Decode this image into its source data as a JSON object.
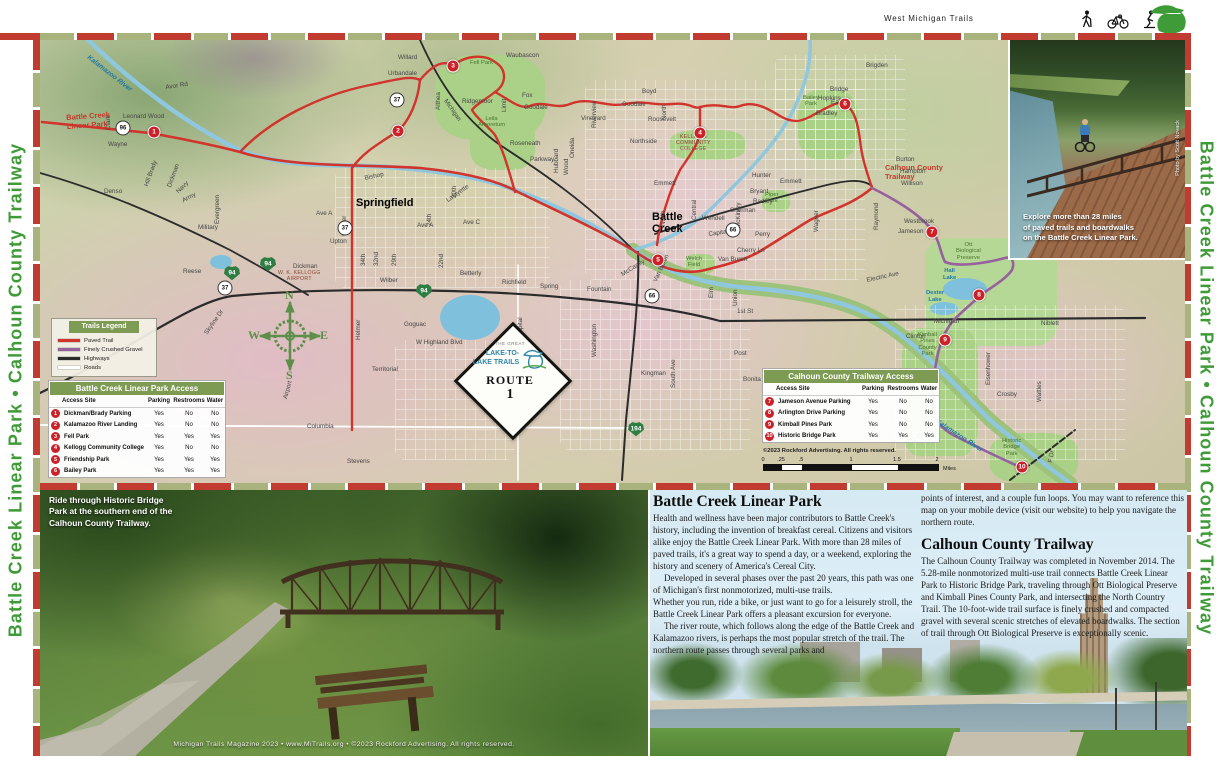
{
  "colors": {
    "accent_red": "#c23b31",
    "dash_green": "#a9b37e",
    "table_green": "#7d9b52",
    "sidebar_green": "#3f9b37",
    "trail_red": "#d0342c",
    "trail_purple": "#96619e",
    "water_blue": "#8ec7de",
    "marker_red": "#cc2128",
    "interstate_green": "#2e7d43"
  },
  "header": {
    "title": "West Michigan Trails"
  },
  "sidebars": {
    "left_text": "Battle Creek Linear Park • Calhoun County Trailway",
    "right_text": "Battle Creek Linear Park • Calhoun County Trailway"
  },
  "map": {
    "legend": {
      "title": "Trails Legend",
      "items": [
        {
          "label": "Paved Trail",
          "color": "#d0342c"
        },
        {
          "label": "Finely Crushed Gravel",
          "color": "#96619e"
        },
        {
          "label": "Highways",
          "color": "#2b2b2b"
        },
        {
          "label": "Roads",
          "color": "#ffffff"
        }
      ]
    },
    "access_tables": [
      {
        "id": "bc",
        "title": "Battle Creek Linear Park Access",
        "columns": [
          "Access Site",
          "Parking",
          "Restrooms",
          "Water"
        ],
        "rows": [
          {
            "num": "1",
            "site": "Dickman/Brady Parking",
            "values": [
              "Yes",
              "No",
              "No"
            ]
          },
          {
            "num": "2",
            "site": "Kalamazoo River Landing",
            "values": [
              "Yes",
              "No",
              "No"
            ]
          },
          {
            "num": "3",
            "site": "Fell Park",
            "values": [
              "Yes",
              "Yes",
              "Yes"
            ]
          },
          {
            "num": "4",
            "site": "Kellogg Community College",
            "values": [
              "Yes",
              "No",
              "No"
            ]
          },
          {
            "num": "5",
            "site": "Friendship Park",
            "values": [
              "Yes",
              "Yes",
              "Yes"
            ]
          },
          {
            "num": "6",
            "site": "Bailey Park",
            "values": [
              "Yes",
              "Yes",
              "Yes"
            ]
          }
        ]
      },
      {
        "id": "cc",
        "title": "Calhoun County Trailway Access",
        "columns": [
          "Access Site",
          "Parking",
          "Restrooms",
          "Water"
        ],
        "rows": [
          {
            "num": "7",
            "site": "Jameson Avenue Parking",
            "values": [
              "Yes",
              "No",
              "No"
            ]
          },
          {
            "num": "8",
            "site": "Arlington Drive Parking",
            "values": [
              "Yes",
              "No",
              "No"
            ]
          },
          {
            "num": "9",
            "site": "Kimball Pines Park",
            "values": [
              "Yes",
              "No",
              "No"
            ]
          },
          {
            "num": "10",
            "site": "Historic Bridge Park",
            "values": [
              "Yes",
              "Yes",
              "Yes"
            ]
          }
        ]
      }
    ],
    "copyright": "©2023 Rockford Advertising. All rights reserved.",
    "scale_bar": {
      "ticks": [
        "0",
        ".25",
        ".5",
        "1",
        "1.5",
        "2"
      ],
      "unit": "Miles"
    },
    "route_badge": {
      "pre": "The Great",
      "name1": "Lake-to-",
      "name2": "Lake Trails",
      "route": "ROUTE",
      "number": "1"
    },
    "compass": {
      "n": "N",
      "e": "E",
      "s": "S",
      "w": "W"
    },
    "markers": [
      {
        "n": "1",
        "x": 114,
        "y": 92
      },
      {
        "n": "2",
        "x": 358,
        "y": 91
      },
      {
        "n": "3",
        "x": 413,
        "y": 26
      },
      {
        "n": "4",
        "x": 660,
        "y": 93
      },
      {
        "n": "5",
        "x": 618,
        "y": 220
      },
      {
        "n": "6",
        "x": 805,
        "y": 64
      },
      {
        "n": "7",
        "x": 892,
        "y": 192
      },
      {
        "n": "8",
        "x": 939,
        "y": 255
      },
      {
        "n": "9",
        "x": 905,
        "y": 300
      },
      {
        "n": "10",
        "x": 982,
        "y": 427
      }
    ],
    "shields": [
      {
        "kind": "c",
        "n": "37",
        "x": 357,
        "y": 60
      },
      {
        "kind": "c",
        "n": "37",
        "x": 305,
        "y": 188
      },
      {
        "kind": "c",
        "n": "37",
        "x": 185,
        "y": 248
      },
      {
        "kind": "c",
        "n": "66",
        "x": 693,
        "y": 190
      },
      {
        "kind": "c",
        "n": "66",
        "x": 612,
        "y": 256
      },
      {
        "kind": "c",
        "n": "96",
        "x": 83,
        "y": 88
      },
      {
        "kind": "i",
        "n": "94",
        "x": 192,
        "y": 233
      },
      {
        "kind": "i",
        "n": "94",
        "x": 228,
        "y": 224
      },
      {
        "kind": "i",
        "n": "94",
        "x": 384,
        "y": 251
      },
      {
        "kind": "i",
        "n": "194",
        "x": 596,
        "y": 389
      }
    ],
    "labels": [
      {
        "t": "Springfield",
        "x": 316,
        "y": 158,
        "c": "city"
      },
      {
        "t": "Battle\nCreek",
        "x": 612,
        "y": 172,
        "c": "city"
      },
      {
        "t": "Battle Creek\nLinear Park",
        "x": 26,
        "y": 74,
        "c": "trailred",
        "r": -4
      },
      {
        "t": "Calhoun County\nTrailway",
        "x": 845,
        "y": 124,
        "c": "trailred"
      },
      {
        "t": "Kalamazoo River",
        "x": 50,
        "y": 14,
        "c": "water",
        "r": 38
      },
      {
        "t": "Kalamazoo River",
        "x": 898,
        "y": 378,
        "c": "water",
        "r": 33
      },
      {
        "t": "Hall\nLake",
        "x": 903,
        "y": 228,
        "c": "water2"
      },
      {
        "t": "Dexter\nLake",
        "x": 886,
        "y": 250,
        "c": "water2"
      },
      {
        "t": "Fell Park",
        "x": 430,
        "y": 20,
        "c": "park-l"
      },
      {
        "t": "Leila\nArboretum",
        "x": 438,
        "y": 76,
        "c": "park-l"
      },
      {
        "t": "Piper\nPark",
        "x": 725,
        "y": 152,
        "c": "park-l"
      },
      {
        "t": "Welch\nField",
        "x": 646,
        "y": 216,
        "c": "park-l"
      },
      {
        "t": "Bailey\nPark",
        "x": 763,
        "y": 55,
        "c": "park-l"
      },
      {
        "t": "Ott\nBiological\nPreserve",
        "x": 916,
        "y": 202,
        "c": "park-l"
      },
      {
        "t": "Kimball\nPines\nCounty\nPark",
        "x": 878,
        "y": 292,
        "c": "park-l"
      },
      {
        "t": "Historic\nBridge\nPark",
        "x": 962,
        "y": 398,
        "c": "park-l"
      },
      {
        "t": "W. K. KELLOGG\nAIRPORT",
        "x": 238,
        "y": 230,
        "c": "apt"
      },
      {
        "t": "KELLOGG\nCOMMUNITY\nCOLLEGE",
        "x": 636,
        "y": 94,
        "c": "apt"
      },
      {
        "t": "Waubascon",
        "x": 466,
        "y": 12
      },
      {
        "t": "Willard",
        "x": 358,
        "y": 14
      },
      {
        "t": "Urbandale",
        "x": 348,
        "y": 30
      },
      {
        "t": "Ridgemoor",
        "x": 422,
        "y": 58
      },
      {
        "t": "Fox",
        "x": 482,
        "y": 52
      },
      {
        "t": "Goodale",
        "x": 484,
        "y": 64
      },
      {
        "t": "Goodale",
        "x": 582,
        "y": 61
      },
      {
        "t": "Roseneath",
        "x": 470,
        "y": 100
      },
      {
        "t": "Boyd",
        "x": 602,
        "y": 48
      },
      {
        "t": "Roosevelt",
        "x": 608,
        "y": 76
      },
      {
        "t": "Northside",
        "x": 590,
        "y": 98
      },
      {
        "t": "Parkway",
        "x": 490,
        "y": 116
      },
      {
        "t": "Emmett",
        "x": 614,
        "y": 140
      },
      {
        "t": "Emmett",
        "x": 740,
        "y": 138
      },
      {
        "t": "Hunter",
        "x": 712,
        "y": 132
      },
      {
        "t": "Bryant",
        "x": 710,
        "y": 148
      },
      {
        "t": "Radley",
        "x": 713,
        "y": 158
      },
      {
        "t": "Sherman",
        "x": 690,
        "y": 167
      },
      {
        "t": "Wendell",
        "x": 662,
        "y": 175
      },
      {
        "t": "Capital",
        "x": 668,
        "y": 191,
        "r": -8
      },
      {
        "t": "Perry",
        "x": 715,
        "y": 191
      },
      {
        "t": "Cherry Ln",
        "x": 697,
        "y": 207
      },
      {
        "t": "Van Buren",
        "x": 678,
        "y": 216
      },
      {
        "t": "Van Buren",
        "x": 612,
        "y": 240,
        "r": -65
      },
      {
        "t": "Wayne",
        "x": 68,
        "y": 101
      },
      {
        "t": "Denso",
        "x": 64,
        "y": 148
      },
      {
        "t": "Military",
        "x": 158,
        "y": 184
      },
      {
        "t": "Reese",
        "x": 143,
        "y": 228
      },
      {
        "t": "Leonard Wood",
        "x": 83,
        "y": 73
      },
      {
        "t": "Avor Rd",
        "x": 125,
        "y": 44,
        "r": -8
      },
      {
        "t": "Dickman",
        "x": 253,
        "y": 223
      },
      {
        "t": "Upton",
        "x": 290,
        "y": 198
      },
      {
        "t": "Wilber",
        "x": 340,
        "y": 237
      },
      {
        "t": "Bishop",
        "x": 324,
        "y": 135,
        "r": -12
      },
      {
        "t": "Ave A",
        "x": 276,
        "y": 170
      },
      {
        "t": "Ave A",
        "x": 377,
        "y": 182
      },
      {
        "t": "Ave C",
        "x": 423,
        "y": 179
      },
      {
        "t": "Betterly",
        "x": 420,
        "y": 230
      },
      {
        "t": "Richfield",
        "x": 462,
        "y": 239
      },
      {
        "t": "Spring",
        "x": 500,
        "y": 243
      },
      {
        "t": "Fountain",
        "x": 547,
        "y": 246
      },
      {
        "t": "Goguac",
        "x": 364,
        "y": 281
      },
      {
        "t": "W Highland Blvd",
        "x": 376,
        "y": 299
      },
      {
        "t": "Territorial",
        "x": 332,
        "y": 326
      },
      {
        "t": "Columbia",
        "x": 267,
        "y": 383
      },
      {
        "t": "Stevens",
        "x": 307,
        "y": 418
      },
      {
        "t": "1st St",
        "x": 697,
        "y": 268
      },
      {
        "t": "Post",
        "x": 694,
        "y": 310
      },
      {
        "t": "Kingman",
        "x": 601,
        "y": 330
      },
      {
        "t": "Bonita",
        "x": 703,
        "y": 336
      },
      {
        "t": "Clinton",
        "x": 866,
        "y": 293
      },
      {
        "t": "Michigan",
        "x": 894,
        "y": 278
      },
      {
        "t": "Niblett",
        "x": 1001,
        "y": 280
      },
      {
        "t": "Crosby",
        "x": 957,
        "y": 351
      },
      {
        "t": "Westbrook",
        "x": 864,
        "y": 178
      },
      {
        "t": "Jameson",
        "x": 858,
        "y": 188
      },
      {
        "t": "Electric Ave",
        "x": 826,
        "y": 237,
        "r": -12
      },
      {
        "t": "Hopkins",
        "x": 778,
        "y": 55
      },
      {
        "t": "Bradley",
        "x": 776,
        "y": 70
      },
      {
        "t": "Bridge",
        "x": 790,
        "y": 46
      },
      {
        "t": "Eaton",
        "x": 791,
        "y": 59
      },
      {
        "t": "Burton",
        "x": 856,
        "y": 116
      },
      {
        "t": "Hampton",
        "x": 860,
        "y": 128
      },
      {
        "t": "Willison",
        "x": 861,
        "y": 140
      },
      {
        "t": "Brigden",
        "x": 826,
        "y": 22
      },
      {
        "t": "G Dr",
        "x": 870,
        "y": 398,
        "r": -28
      },
      {
        "t": "F Dr",
        "x": 1007,
        "y": 422,
        "r": -80
      },
      {
        "t": "Raymond",
        "x": 833,
        "y": 190,
        "r": -90
      },
      {
        "t": "Wattles",
        "x": 996,
        "y": 362,
        "r": -90
      },
      {
        "t": "Eisenhower",
        "x": 945,
        "y": 345,
        "r": -90
      },
      {
        "t": "Helmer",
        "x": 301,
        "y": 196,
        "r": -90
      },
      {
        "t": "Helmer",
        "x": 315,
        "y": 300,
        "r": -90
      },
      {
        "t": "Althea",
        "x": 395,
        "y": 70,
        "r": -90
      },
      {
        "t": "Limit",
        "x": 461,
        "y": 72,
        "r": -90
      },
      {
        "t": "Hubbard",
        "x": 513,
        "y": 133,
        "r": -90
      },
      {
        "t": "Wood",
        "x": 523,
        "y": 135,
        "r": -90
      },
      {
        "t": "Oneida",
        "x": 529,
        "y": 118,
        "r": -90
      },
      {
        "t": "Vineyard",
        "x": 541,
        "y": 75
      },
      {
        "t": "Riverview",
        "x": 551,
        "y": 88,
        "r": -90
      },
      {
        "t": "North",
        "x": 621,
        "y": 80,
        "r": -90
      },
      {
        "t": "Central",
        "x": 651,
        "y": 180,
        "r": -90
      },
      {
        "t": "North",
        "x": 620,
        "y": 186,
        "r": -90
      },
      {
        "t": "McKinley",
        "x": 695,
        "y": 188,
        "r": -90
      },
      {
        "t": "Wagner",
        "x": 773,
        "y": 192,
        "r": -90
      },
      {
        "t": "24th",
        "x": 386,
        "y": 186,
        "r": -90
      },
      {
        "t": "22nd",
        "x": 398,
        "y": 228,
        "r": -90
      },
      {
        "t": "34th",
        "x": 320,
        "y": 226,
        "r": -90
      },
      {
        "t": "32nd",
        "x": 333,
        "y": 226,
        "r": -90
      },
      {
        "t": "29th",
        "x": 351,
        "y": 226,
        "r": -90
      },
      {
        "t": "20th",
        "x": 411,
        "y": 158,
        "r": -90
      },
      {
        "t": "Lafayette",
        "x": 405,
        "y": 158,
        "r": -35
      },
      {
        "t": "Michigan",
        "x": 408,
        "y": 58,
        "r": 55
      },
      {
        "t": "Skyline Dr",
        "x": 163,
        "y": 292,
        "r": -55
      },
      {
        "t": "Airport",
        "x": 242,
        "y": 358,
        "r": -75
      },
      {
        "t": "Hill Brady",
        "x": 103,
        "y": 145,
        "r": -70
      },
      {
        "t": "Dickman",
        "x": 126,
        "y": 146,
        "r": -70
      },
      {
        "t": "Navy",
        "x": 135,
        "y": 150,
        "r": -45
      },
      {
        "t": "Army",
        "x": 141,
        "y": 158,
        "r": -28
      },
      {
        "t": "Evergreen",
        "x": 174,
        "y": 184,
        "r": -90
      },
      {
        "t": "Clark",
        "x": 65,
        "y": 90,
        "r": -90
      },
      {
        "t": "South Ave",
        "x": 630,
        "y": 348,
        "r": -90
      },
      {
        "t": "Union",
        "x": 692,
        "y": 266,
        "r": -90
      },
      {
        "t": "Elm",
        "x": 668,
        "y": 258,
        "r": -90
      },
      {
        "t": "McCamly",
        "x": 580,
        "y": 232,
        "r": -32
      },
      {
        "t": "Washington",
        "x": 551,
        "y": 317,
        "r": -90
      },
      {
        "t": "Capital",
        "x": 477,
        "y": 297,
        "r": -90
      }
    ]
  },
  "photo_inset": {
    "caption": "Explore more than 28 miles\nof paved trails and boardwalks\non the Battle Creek Linear Park.",
    "credit": "Photo by Scott Novack"
  },
  "bottom_left": {
    "caption": "Ride through Historic Bridge\nPark at the southern end of the\nCalhoun County Trailway.",
    "footer": "Michigan Trails Magazine 2023 • www.MiTrails.org • ©2023 Rockford Advertising. All rights reserved."
  },
  "articles": {
    "col1": {
      "title": "Battle Creek Linear Park",
      "paragraphs": [
        "Health and wellness have been major contributors to Battle Creek's history, including the invention of breakfast cereal. Citizens and visitors alike enjoy the Battle Creek Linear Park. With more than 28 miles of paved trails, it's a great way to spend a day, or a weekend, exploring the history and scenery of America's Cereal City.",
        "Developed in several phases over the past 20 years, this path was one of Michigan's first nonmotorized, multi-use trails.",
        "Whether you run, ride a bike, or just want to go for a leisurely stroll, the Battle Creek Linear Park offers a pleasant excursion for everyone.",
        "The river route, which follows along the edge of the Battle Creek and Kalamazoo rivers, is perhaps the most popular stretch of the trail. The northern route passes through several parks and"
      ]
    },
    "col2": {
      "intro": "points of interest, and a couple fun loops. You may want to reference this map on your mobile device (visit our website) to help you navigate the northern route.",
      "title": "Calhoun County Trailway",
      "paragraphs": [
        "The Calhoun County Trailway was completed in November 2014. The 5.28-mile nonmotorized multi-use trail connects Battle Creek Linear Park to Historic Bridge Park, traveling through Ott Biological Preserve and Kimball Pines County Park, and intersecting the North Country Trail. The 10-foot-wide trail surface is finely crushed and compacted gravel with several scenic stretches of elevated boardwalks. The section of trail through Ott Biological Preserve is exceptionally scenic."
      ]
    }
  }
}
